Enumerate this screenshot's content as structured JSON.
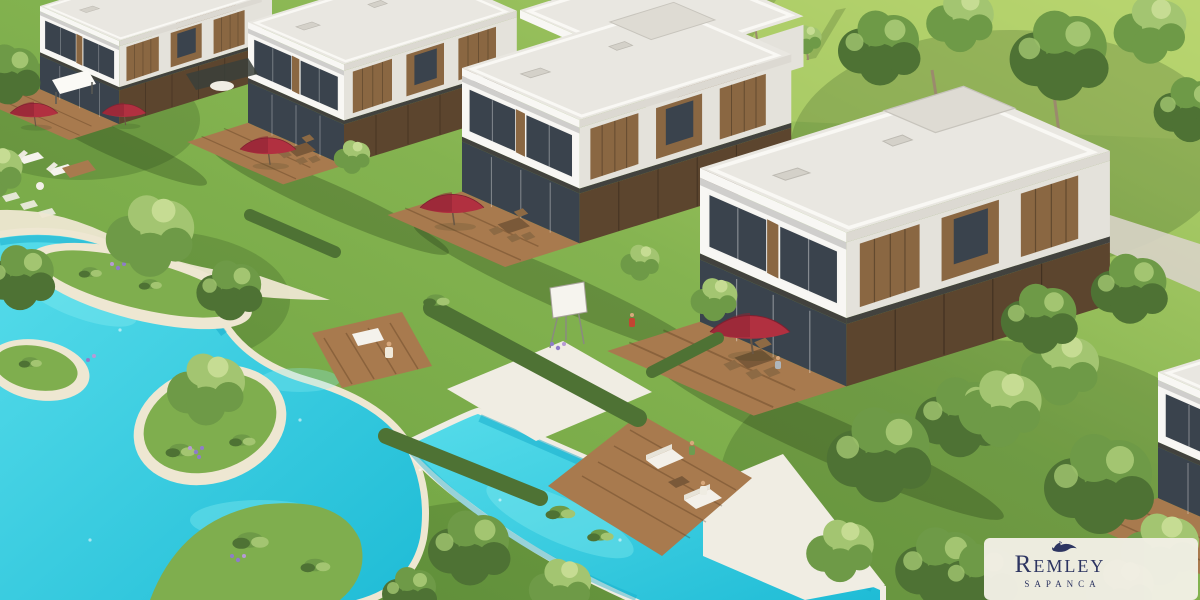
{
  "scene": {
    "type": "aerial-architectural-render",
    "elements": [
      "villa",
      "villa-roof",
      "wood-facade-panels",
      "lagoon-pool",
      "channel-pool",
      "pool-island",
      "wooden-deck",
      "red-umbrella",
      "dining-set",
      "lounge-sofa",
      "chaise-lounge",
      "easel",
      "garden-tree",
      "hedge",
      "flower-cluster",
      "stone-terrace",
      "gravel-path",
      "person",
      "logo-card"
    ]
  },
  "logo": {
    "title": "Remley",
    "subtitle": "SAPANCA",
    "icon": "dolphin-icon"
  },
  "colors": {
    "grass": "#84b350",
    "grass_light": "#b9d56f",
    "grass_dark": "#6ba03f",
    "pool": "#2ecbe2",
    "pool_deep": "#14a9c9",
    "pool_light": "#8deef2",
    "sand": "#eee7d2",
    "stone": "#f0ede3",
    "roof": "#e9e7e1",
    "wall": "#f8f7f4",
    "wall_shade": "#e4e2db",
    "glass": "#3a434d",
    "wood": "#8a6742",
    "wood_dark": "#5c452e",
    "deck": "#a87a4e",
    "tree_dark": "#4e7234",
    "tree_mid": "#6e9a47",
    "tree_light": "#a3c571",
    "tree_pale": "#c6dc93",
    "trunk": "#9b8a6d",
    "umbrella": "#b13040",
    "umbrella_dark": "#8c2433",
    "skin": "#d7a87c",
    "logo_card": "#f2efe5",
    "logo_text": "#2b3263",
    "shadow": "rgba(30,50,18,0.28)"
  }
}
